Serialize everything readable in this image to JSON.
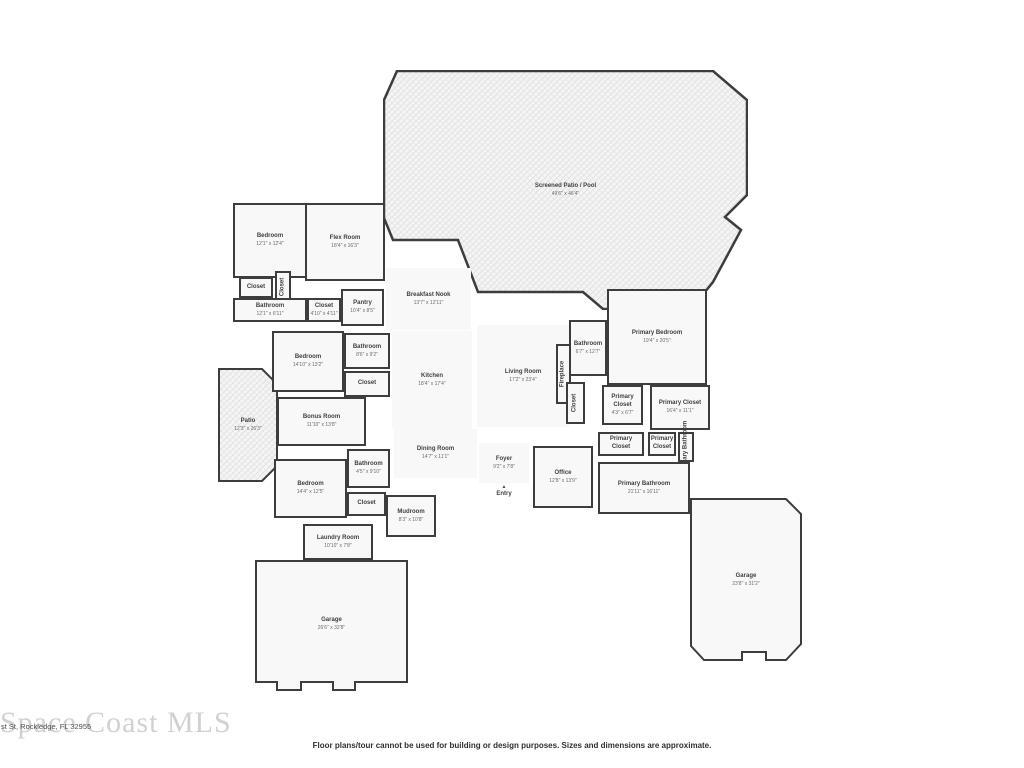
{
  "footer": {
    "address": "st St, Rockledge, FL 32955",
    "watermark": "Space Coast MLS",
    "disclaimer": "Floor plans/tour cannot be used for building or design purposes. Sizes and dimensions are approximate."
  },
  "colors": {
    "wall": "#3d3d3d",
    "room_fill": "#f8f8f8",
    "patio_hatch_fill": "#f5f5f5",
    "label_text": "#3f3f3f",
    "dims_text": "#6b6b6b",
    "watermark_text": "#c9c9c9"
  },
  "rooms": [
    {
      "id": "screened-patio-pool",
      "name": "Screened Patio / Pool",
      "dims": "49'6\" x 46'4\"",
      "kind": "label",
      "x": 383,
      "y": 70,
      "w": 365,
      "h": 240
    },
    {
      "id": "bedroom-upper",
      "name": "Bedroom",
      "dims": "12'1\" x 12'4\"",
      "kind": "room",
      "x": 233,
      "y": 203,
      "w": 74,
      "h": 75
    },
    {
      "id": "flex-room",
      "name": "Flex Room",
      "dims": "18'4\" x 16'3\"",
      "kind": "room",
      "x": 305,
      "y": 203,
      "w": 80,
      "h": 78
    },
    {
      "id": "closet-upper-left",
      "name": "Closet",
      "kind": "room",
      "x": 239,
      "y": 277,
      "w": 34,
      "h": 21
    },
    {
      "id": "closet-upper-mid",
      "name": "Closet",
      "kind": "room",
      "rot": true,
      "x": 275,
      "y": 271,
      "w": 16,
      "h": 31
    },
    {
      "id": "bathroom-upper",
      "name": "Bathroom",
      "dims": "12'1\" x 6'11\"",
      "kind": "room",
      "x": 233,
      "y": 298,
      "w": 74,
      "h": 24
    },
    {
      "id": "closet-upper-right",
      "name": "Closet",
      "dims": "4'10\" x 4'11\"",
      "kind": "room",
      "x": 307,
      "y": 298,
      "w": 34,
      "h": 24
    },
    {
      "id": "pantry",
      "name": "Pantry",
      "dims": "10'4\" x 8'5\"",
      "kind": "room",
      "x": 341,
      "y": 289,
      "w": 43,
      "h": 37
    },
    {
      "id": "breakfast-nook",
      "name": "Breakfast Nook",
      "dims": "13'7\" x 12'11\"",
      "kind": "open",
      "x": 386,
      "y": 268,
      "w": 85,
      "h": 62
    },
    {
      "id": "bedroom-mid",
      "name": "Bedroom",
      "dims": "14'10\" x 13'2\"",
      "kind": "room",
      "x": 272,
      "y": 331,
      "w": 72,
      "h": 61
    },
    {
      "id": "bathroom-mid",
      "name": "Bathroom",
      "dims": "8'6\" x 9'2\"",
      "kind": "room",
      "x": 344,
      "y": 333,
      "w": 46,
      "h": 36
    },
    {
      "id": "closet-mid",
      "name": "Closet",
      "kind": "room",
      "x": 344,
      "y": 371,
      "w": 46,
      "h": 26
    },
    {
      "id": "kitchen",
      "name": "Kitchen",
      "dims": "18'4\" x 17'4\"",
      "kind": "open",
      "x": 392,
      "y": 331,
      "w": 80,
      "h": 98
    },
    {
      "id": "living-room",
      "name": "Living Room",
      "dims": "17'2\" x 23'4\"",
      "kind": "open",
      "x": 477,
      "y": 325,
      "w": 92,
      "h": 102
    },
    {
      "id": "fireplace",
      "name": "Fireplace",
      "kind": "room",
      "rot": true,
      "x": 556,
      "y": 344,
      "w": 15,
      "h": 60
    },
    {
      "id": "bathroom-right",
      "name": "Bathroom",
      "dims": "6'7\" x 12'7\"",
      "kind": "room",
      "x": 569,
      "y": 320,
      "w": 38,
      "h": 56
    },
    {
      "id": "primary-bedroom",
      "name": "Primary Bedroom",
      "dims": "19'4\" x 20'5\"",
      "kind": "room",
      "x": 607,
      "y": 289,
      "w": 100,
      "h": 96
    },
    {
      "id": "closet-hall",
      "name": "Closet",
      "kind": "room",
      "rot": true,
      "x": 566,
      "y": 382,
      "w": 19,
      "h": 42
    },
    {
      "id": "primary-closet-small",
      "name": "Primary Closet",
      "dims": "4'3\" x 6'7\"",
      "kind": "room",
      "x": 602,
      "y": 385,
      "w": 41,
      "h": 40
    },
    {
      "id": "primary-closet-large",
      "name": "Primary Closet",
      "dims": "16'4\" x 11'1\"",
      "kind": "room",
      "x": 650,
      "y": 385,
      "w": 60,
      "h": 45
    },
    {
      "id": "patio",
      "name": "Patio",
      "dims": "12'3\" x 26'3\"",
      "kind": "label",
      "x": 218,
      "y": 368,
      "w": 60,
      "h": 114
    },
    {
      "id": "bonus-room",
      "name": "Bonus Room",
      "dims": "11'10\" x 13'8\"",
      "kind": "room",
      "x": 277,
      "y": 397,
      "w": 89,
      "h": 49
    },
    {
      "id": "dining-room",
      "name": "Dining Room",
      "dims": "14'7\" x 11'1\"",
      "kind": "open",
      "x": 394,
      "y": 429,
      "w": 83,
      "h": 49
    },
    {
      "id": "bathroom-lower",
      "name": "Bathroom",
      "dims": "4'5\" x 9'10\"",
      "kind": "room",
      "x": 347,
      "y": 449,
      "w": 43,
      "h": 39
    },
    {
      "id": "bedroom-lower",
      "name": "Bedroom",
      "dims": "14'4\" x 12'5\"",
      "kind": "room",
      "x": 274,
      "y": 459,
      "w": 73,
      "h": 59
    },
    {
      "id": "closet-lower",
      "name": "Closet",
      "kind": "room",
      "x": 347,
      "y": 492,
      "w": 39,
      "h": 24
    },
    {
      "id": "foyer",
      "name": "Foyer",
      "dims": "9'2\" x 7'8\"",
      "kind": "open",
      "x": 479,
      "y": 443,
      "w": 50,
      "h": 40
    },
    {
      "id": "entry",
      "name": "Entry",
      "kind": "entry",
      "x": 486,
      "y": 481,
      "w": 36,
      "h": 22
    },
    {
      "id": "mudroom",
      "name": "Mudroom",
      "dims": "8'3\" x 10'8\"",
      "kind": "room",
      "x": 386,
      "y": 495,
      "w": 50,
      "h": 42
    },
    {
      "id": "laundry-room",
      "name": "Laundry Room",
      "dims": "10'10\" x 7'8\"",
      "kind": "room",
      "x": 303,
      "y": 524,
      "w": 70,
      "h": 36
    },
    {
      "id": "office",
      "name": "Office",
      "dims": "12'8\" x 13'9\"",
      "kind": "room",
      "x": 533,
      "y": 446,
      "w": 60,
      "h": 62
    },
    {
      "id": "primary-closet-hall-a",
      "name": "Primary Closet",
      "kind": "room",
      "x": 598,
      "y": 432,
      "w": 46,
      "h": 24
    },
    {
      "id": "primary-closet-hall-b",
      "name": "Primary Closet",
      "kind": "room",
      "x": 648,
      "y": 432,
      "w": 28,
      "h": 24
    },
    {
      "id": "primary-bath-wc",
      "name": "Primary Bathroom",
      "kind": "room",
      "rot": true,
      "x": 678,
      "y": 432,
      "w": 16,
      "h": 30
    },
    {
      "id": "primary-bathroom",
      "name": "Primary Bathroom",
      "dims": "21'11\" x 16'11\"",
      "kind": "room",
      "x": 598,
      "y": 462,
      "w": 92,
      "h": 52
    },
    {
      "id": "garage-main",
      "name": "Garage",
      "dims": "26'6\" x 32'8\"",
      "kind": "label",
      "x": 255,
      "y": 560,
      "w": 153,
      "h": 128
    },
    {
      "id": "garage-second",
      "name": "Garage",
      "dims": "23'8\" x 31'2\"",
      "kind": "label",
      "x": 690,
      "y": 498,
      "w": 112,
      "h": 164
    }
  ]
}
